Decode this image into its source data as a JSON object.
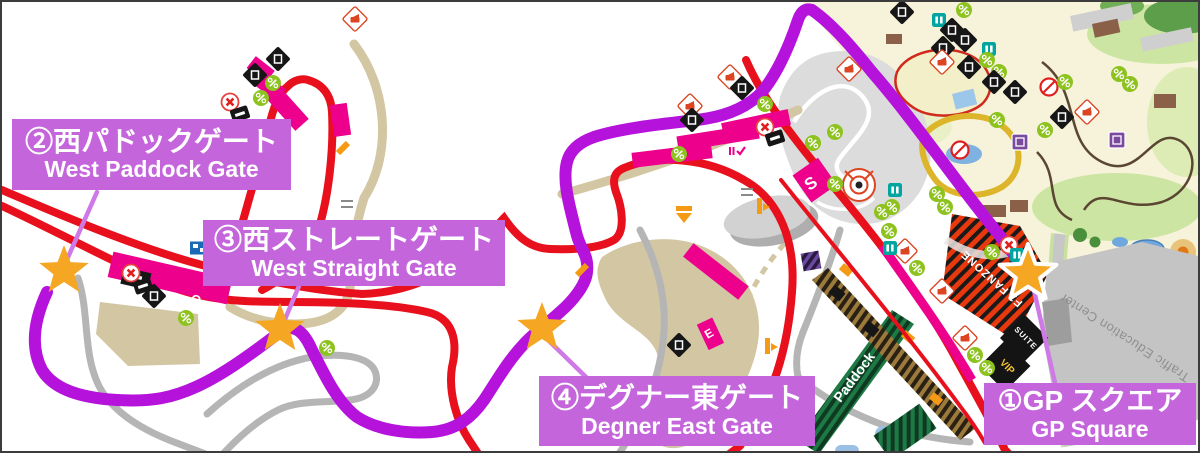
{
  "map": {
    "name": "Suzuka Circuit gate access map",
    "colors": {
      "route_purple": "#b512dc",
      "connector_purple": "#cf79e6",
      "label_purple": "#c465dc",
      "track_red": "#e8101c",
      "grandstand_pink": "#ec008c",
      "road_tan": "#d3c6a2",
      "road_gray": "#b5b5b5",
      "star_orange": "#f5a623",
      "park_cream": "#f6f3da",
      "park_green": "#cde5a2",
      "icon_green": "#8dc21f"
    },
    "gates": [
      {
        "id": 1,
        "jp": "①GP スクエア",
        "en": "GP Square",
        "star": {
          "x": 1026,
          "y": 272
        },
        "outlined": true,
        "label_box": {
          "x": 982,
          "y": 381,
          "w": 212,
          "h": 62
        }
      },
      {
        "id": 2,
        "jp": "②西パドックゲート",
        "en": "West Paddock Gate",
        "star": {
          "x": 62,
          "y": 269
        },
        "outlined": false,
        "label_box": {
          "x": 10,
          "y": 117,
          "w": 279,
          "h": 71
        }
      },
      {
        "id": 3,
        "jp": "③西ストレートゲート",
        "en": "West Straight Gate",
        "star": {
          "x": 278,
          "y": 327
        },
        "outlined": false,
        "label_box": {
          "x": 201,
          "y": 218,
          "w": 302,
          "h": 66
        }
      },
      {
        "id": 4,
        "jp": "④デグナー東ゲート",
        "en": "Degner East Gate",
        "star": {
          "x": 540,
          "y": 326
        },
        "outlined": false,
        "label_box": {
          "x": 537,
          "y": 374,
          "w": 276,
          "h": 70
        }
      }
    ],
    "areas": {
      "paddock": "Paddock",
      "fan_zone": "F1 FANZONE",
      "traffic_education_center": "Traffic Education Center",
      "suite": "SUITE",
      "vip": "VIP"
    },
    "stands": [
      {
        "ch": "S",
        "x": 812,
        "y": 186,
        "rot": -35
      },
      {
        "ch": "O",
        "x": 193,
        "y": 302,
        "rot": 13
      },
      {
        "ch": "E",
        "x": 709,
        "y": 335,
        "rot": -30
      }
    ],
    "icon_types": {
      "green": "concession-icon",
      "blackdiamond": "facility-icon",
      "photodiamond": "photo-spot-icon",
      "noentry": "closed-icon",
      "prohibit": "no-entry-icon",
      "teal": "info-icon",
      "screen": "vision-screen-icon",
      "orangetick": "gate-marker-icon",
      "orangearrow": "direction-arrow-icon",
      "orangeflag": "flag-marker-icon",
      "purplesquare": "attraction-icon",
      "check": "ticket-check-icon",
      "blackbar": "counter-icon",
      "bridge": "bridge-crossing-icon"
    },
    "icons": [
      {
        "t": "noentry",
        "x": 228,
        "y": 100
      },
      {
        "t": "blackbar",
        "x": 238,
        "y": 112
      },
      {
        "t": "blackdiamond",
        "x": 253,
        "y": 73
      },
      {
        "t": "green",
        "x": 259,
        "y": 96
      },
      {
        "t": "green",
        "x": 271,
        "y": 81
      },
      {
        "t": "blackdiamond",
        "x": 276,
        "y": 57
      },
      {
        "t": "photodiamond",
        "x": 353,
        "y": 17
      },
      {
        "t": "orangetick",
        "x": 341,
        "y": 146
      },
      {
        "t": "noentry",
        "x": 129,
        "y": 271
      },
      {
        "t": "blackbar",
        "x": 141,
        "y": 284
      },
      {
        "t": "blackdiamond",
        "x": 152,
        "y": 294
      },
      {
        "t": "green",
        "x": 184,
        "y": 316
      },
      {
        "t": "screen",
        "x": 197,
        "y": 246
      },
      {
        "t": "green",
        "x": 325,
        "y": 346
      },
      {
        "t": "bridge",
        "x": 345,
        "y": 202
      },
      {
        "t": "bridge",
        "x": 349,
        "y": 251
      },
      {
        "t": "bridge",
        "x": 745,
        "y": 190
      },
      {
        "t": "green",
        "x": 677,
        "y": 152
      },
      {
        "t": "photodiamond",
        "x": 688,
        "y": 104
      },
      {
        "t": "blackdiamond",
        "x": 690,
        "y": 118
      },
      {
        "t": "check",
        "x": 734,
        "y": 149
      },
      {
        "t": "noentry",
        "x": 763,
        "y": 125
      },
      {
        "t": "blackbar",
        "x": 773,
        "y": 136
      },
      {
        "t": "green",
        "x": 763,
        "y": 102
      },
      {
        "t": "photodiamond",
        "x": 728,
        "y": 75
      },
      {
        "t": "blackdiamond",
        "x": 740,
        "y": 86
      },
      {
        "t": "orangearrow",
        "x": 682,
        "y": 212
      },
      {
        "t": "orangeflag",
        "x": 757,
        "y": 204
      },
      {
        "t": "orangetick",
        "x": 580,
        "y": 268
      },
      {
        "t": "blackdiamond",
        "x": 677,
        "y": 343
      },
      {
        "t": "orangeflag",
        "x": 765,
        "y": 344
      },
      {
        "t": "green",
        "x": 887,
        "y": 229
      },
      {
        "t": "green",
        "x": 915,
        "y": 266
      },
      {
        "t": "photodiamond",
        "x": 903,
        "y": 249
      },
      {
        "t": "photodiamond",
        "x": 940,
        "y": 289
      },
      {
        "t": "photodiamond",
        "x": 963,
        "y": 336
      },
      {
        "t": "green",
        "x": 973,
        "y": 353
      },
      {
        "t": "green",
        "x": 985,
        "y": 366
      },
      {
        "t": "teal",
        "x": 888,
        "y": 246
      },
      {
        "t": "prohibit",
        "x": 958,
        "y": 148
      },
      {
        "t": "teal",
        "x": 893,
        "y": 188
      },
      {
        "t": "green",
        "x": 833,
        "y": 130
      },
      {
        "t": "green",
        "x": 811,
        "y": 141
      },
      {
        "t": "green",
        "x": 833,
        "y": 182
      },
      {
        "t": "green",
        "x": 890,
        "y": 205
      },
      {
        "t": "noentry",
        "x": 1007,
        "y": 243
      },
      {
        "t": "green",
        "x": 990,
        "y": 250
      },
      {
        "t": "teal",
        "x": 1015,
        "y": 253
      },
      {
        "t": "blackdiamond",
        "x": 900,
        "y": 10
      },
      {
        "t": "green",
        "x": 962,
        "y": 8
      },
      {
        "t": "teal",
        "x": 937,
        "y": 18
      },
      {
        "t": "blackdiamond",
        "x": 950,
        "y": 28
      },
      {
        "t": "blackdiamond",
        "x": 963,
        "y": 38
      },
      {
        "t": "blackdiamond",
        "x": 941,
        "y": 46
      },
      {
        "t": "photodiamond",
        "x": 847,
        "y": 67
      },
      {
        "t": "photodiamond",
        "x": 940,
        "y": 60
      },
      {
        "t": "teal",
        "x": 987,
        "y": 47
      },
      {
        "t": "green",
        "x": 985,
        "y": 58
      },
      {
        "t": "green",
        "x": 997,
        "y": 70
      },
      {
        "t": "blackdiamond",
        "x": 967,
        "y": 65
      },
      {
        "t": "blackdiamond",
        "x": 992,
        "y": 80
      },
      {
        "t": "prohibit",
        "x": 1047,
        "y": 85
      },
      {
        "t": "green",
        "x": 1063,
        "y": 80
      },
      {
        "t": "blackdiamond",
        "x": 1013,
        "y": 90
      },
      {
        "t": "green",
        "x": 1117,
        "y": 72
      },
      {
        "t": "green",
        "x": 1128,
        "y": 82
      },
      {
        "t": "photodiamond",
        "x": 1085,
        "y": 110
      },
      {
        "t": "blackdiamond",
        "x": 1060,
        "y": 115
      },
      {
        "t": "green",
        "x": 995,
        "y": 118
      },
      {
        "t": "green",
        "x": 1043,
        "y": 128
      },
      {
        "t": "purplesquare",
        "x": 1018,
        "y": 140
      },
      {
        "t": "purplesquare",
        "x": 1115,
        "y": 138
      },
      {
        "t": "green",
        "x": 935,
        "y": 192
      },
      {
        "t": "green",
        "x": 943,
        "y": 205
      },
      {
        "t": "green",
        "x": 880,
        "y": 210
      }
    ]
  }
}
